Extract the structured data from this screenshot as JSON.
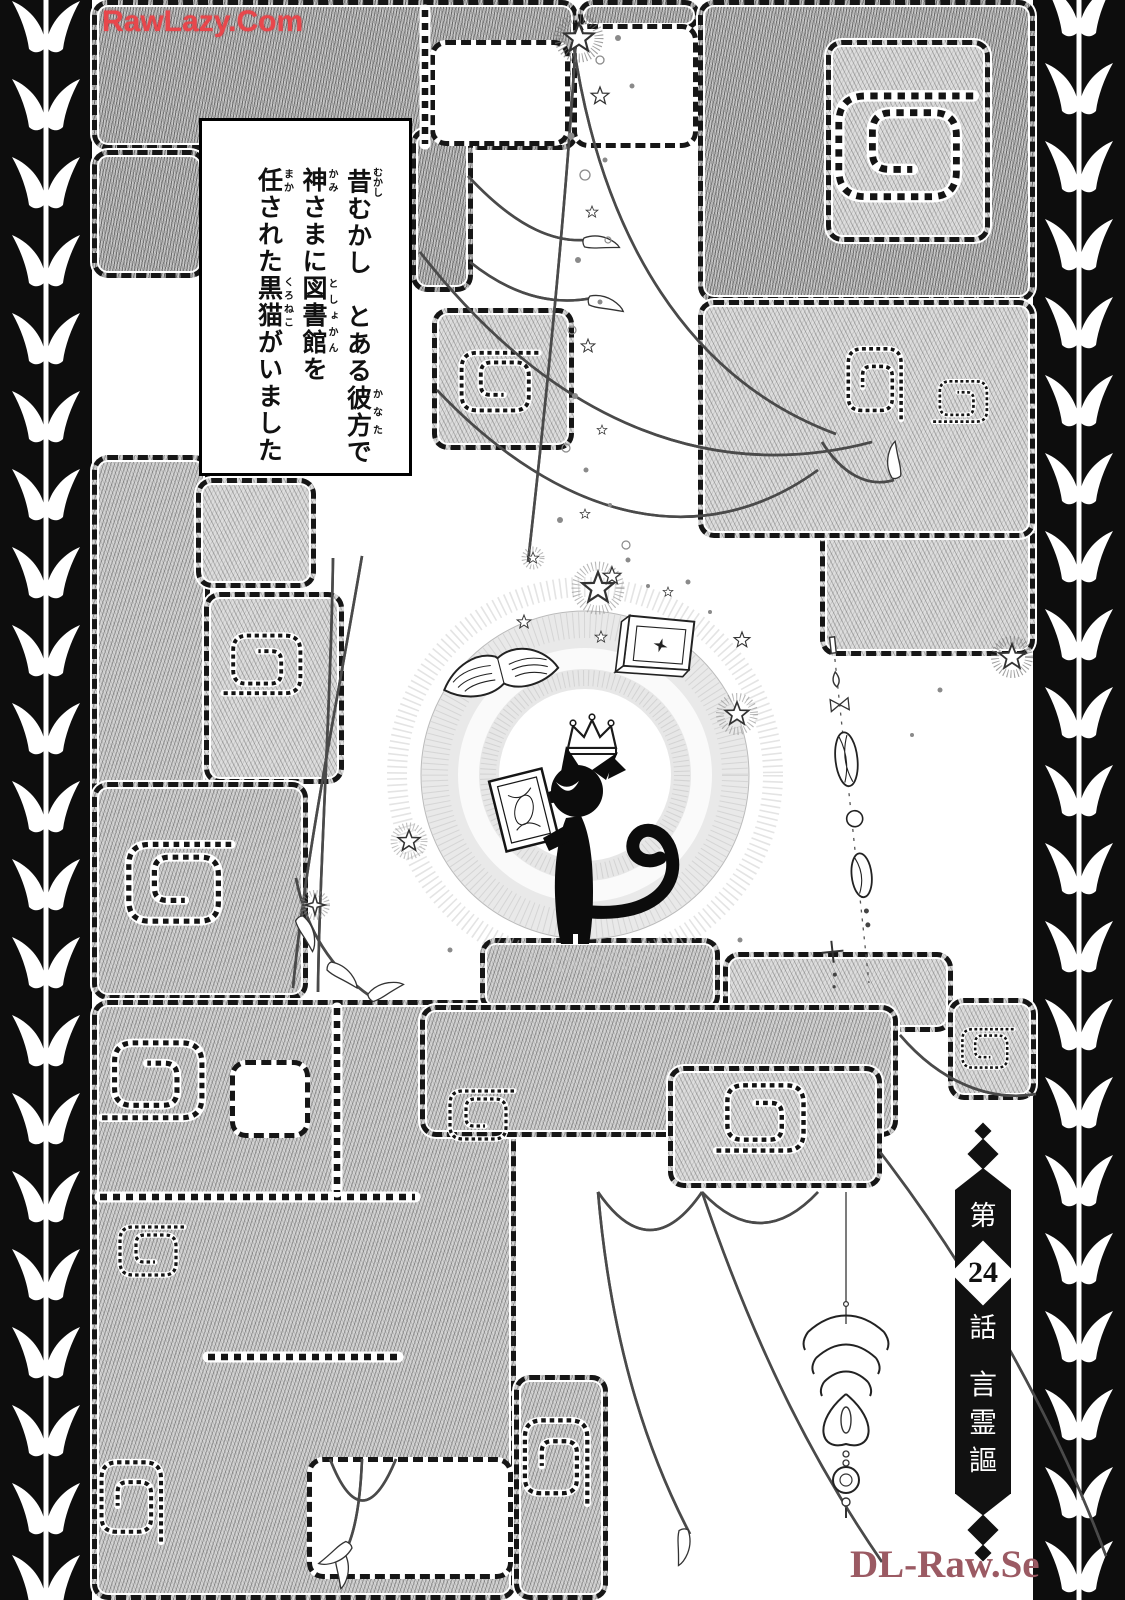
{
  "watermarks": {
    "top_left": {
      "text": "RawLazy.Com",
      "color": "#e8474c"
    },
    "bottom_right": {
      "text": "DL-Raw.Se",
      "color": "#9b5a63"
    }
  },
  "narration_box": {
    "lines": [
      [
        {
          "t": "昔",
          "r": "むかし"
        },
        {
          "t": "むかし　とある"
        },
        {
          "t": "彼方",
          "r": "かなた"
        },
        {
          "t": "で"
        }
      ],
      [
        {
          "t": "神",
          "r": "かみ"
        },
        {
          "t": "さまに"
        },
        {
          "t": "図書館",
          "r": "としょかん"
        },
        {
          "t": "を"
        }
      ],
      [
        {
          "t": "任",
          "r": "まか"
        },
        {
          "t": "された"
        },
        {
          "t": "黒猫",
          "r": "くろねこ"
        },
        {
          "t": "がいました"
        }
      ]
    ]
  },
  "chapter_banner": {
    "prefix": "第",
    "number": "24",
    "suffix": "話",
    "title": "言霊謳"
  },
  "art": {
    "central_figure": "black-cat-silhouette-with-crown-holding-book",
    "floating_items": "open-book, closed-book, crown, stars, bead-string, flower-drop-ornament",
    "background": "crosshatched-maze-blocks-with-spiral-cutouts",
    "side_borders": "black-strip-with-white-leaf-vine"
  },
  "colors": {
    "ink": "#111111",
    "hatch_gray": "#cccccc",
    "watermark_red": "#e8474c",
    "watermark_maroon": "#9b5a63"
  }
}
